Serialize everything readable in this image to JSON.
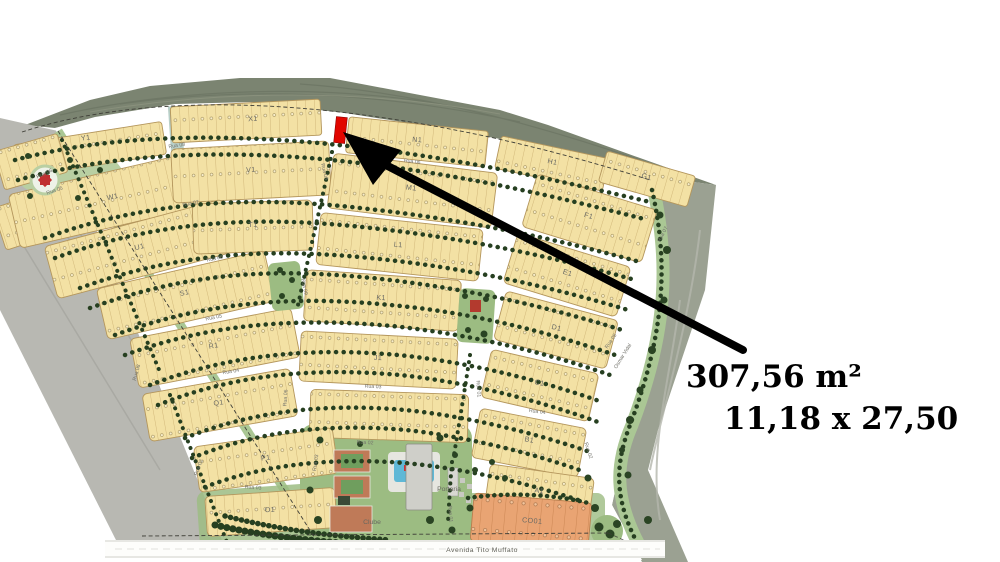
{
  "annotation": {
    "line1": "307,56 m²",
    "line2": "11,18 x 27,50"
  },
  "map": {
    "avenue_label": "Avenida Tito Muffato",
    "club_label": "Clube",
    "gatehouse_label": "Portaria",
    "commercial_label": "CO01",
    "block_labels": [
      {
        "text": "Y1"
      },
      {
        "text": "X1"
      },
      {
        "text": "N1"
      },
      {
        "text": "H1"
      },
      {
        "text": "G1"
      },
      {
        "text": "W1"
      },
      {
        "text": "V1"
      },
      {
        "text": "M1"
      },
      {
        "text": "F1"
      },
      {
        "text": "U1"
      },
      {
        "text": "T1"
      },
      {
        "text": "L1"
      },
      {
        "text": "E1"
      },
      {
        "text": "S1"
      },
      {
        "text": "K1"
      },
      {
        "text": "D1"
      },
      {
        "text": "R1"
      },
      {
        "text": "J1"
      },
      {
        "text": "C1"
      },
      {
        "text": "Q1"
      },
      {
        "text": "B1"
      },
      {
        "text": "P1"
      },
      {
        "text": "A1"
      },
      {
        "text": "O1"
      }
    ],
    "street_labels": [
      {
        "text": "Rua 08"
      },
      {
        "text": "Rua 09"
      },
      {
        "text": "Rua 06"
      },
      {
        "text": "Rua 07"
      },
      {
        "text": "Rua 07"
      },
      {
        "text": "Rua 06"
      },
      {
        "text": "Rua 09"
      },
      {
        "text": "Rua 05"
      },
      {
        "text": "Rua 05"
      },
      {
        "text": "Rua 04"
      },
      {
        "text": "Rua 04"
      },
      {
        "text": "Rua 03"
      },
      {
        "text": "Rua 08"
      },
      {
        "text": "Rua 06"
      },
      {
        "text": "Rua 01"
      },
      {
        "text": "Rua 02"
      },
      {
        "text": "Rua 02"
      },
      {
        "text": "Rua 03"
      },
      {
        "text": "Rua 01"
      },
      {
        "text": "Osmar Vidal"
      },
      {
        "text": "Rua 06"
      },
      {
        "text": "Rua 05"
      },
      {
        "text": "Rua 02"
      },
      {
        "text": "Rua 03"
      }
    ],
    "colors": {
      "highlight_red": "#e10600",
      "lot_tan": "#f3e1a4",
      "commercial_orange": "#e9a473",
      "green_verge": "#aac794",
      "terrain_gray": "#b8b8b2",
      "terrain_olive": "#7b8471"
    }
  }
}
